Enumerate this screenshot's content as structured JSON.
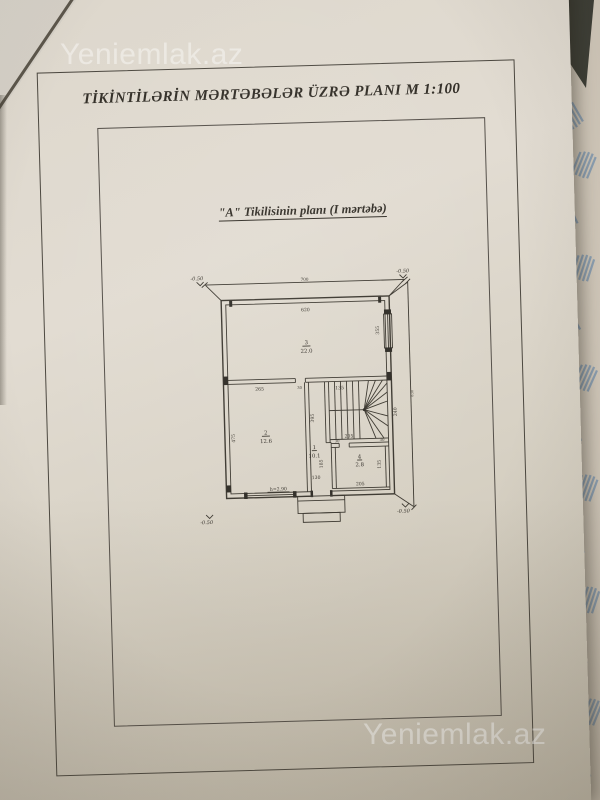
{
  "watermarks": {
    "top": "Yeniemlak.az",
    "bottom": "Yeniemlak.az"
  },
  "document": {
    "title": "TİKİNTİLƏRİN MƏRTƏBƏLƏR ÜZRƏ PLANI  M 1:100",
    "subtitle": "\"A\" Tikilisinin planı (I mərtəbə)"
  },
  "plan": {
    "dim_top": "700",
    "dim_right": "830",
    "elev": "-0.50",
    "room3": {
      "num": "3",
      "area": "22.0",
      "w": "620",
      "d": "355"
    },
    "room2": {
      "num": "2",
      "area": "12.6",
      "w": "265",
      "d": "475",
      "h": "h=2.90"
    },
    "room1": {
      "num": "1",
      "area": "10.1",
      "d": "395",
      "d2": "185",
      "w": "130"
    },
    "room4": {
      "num": "4",
      "area": "2.8",
      "w": "205",
      "d": "135",
      "j1": "30",
      "j2": "30"
    },
    "stairs": {
      "top": "135",
      "bottom": "205",
      "side": "240"
    },
    "door_gap": "30"
  }
}
